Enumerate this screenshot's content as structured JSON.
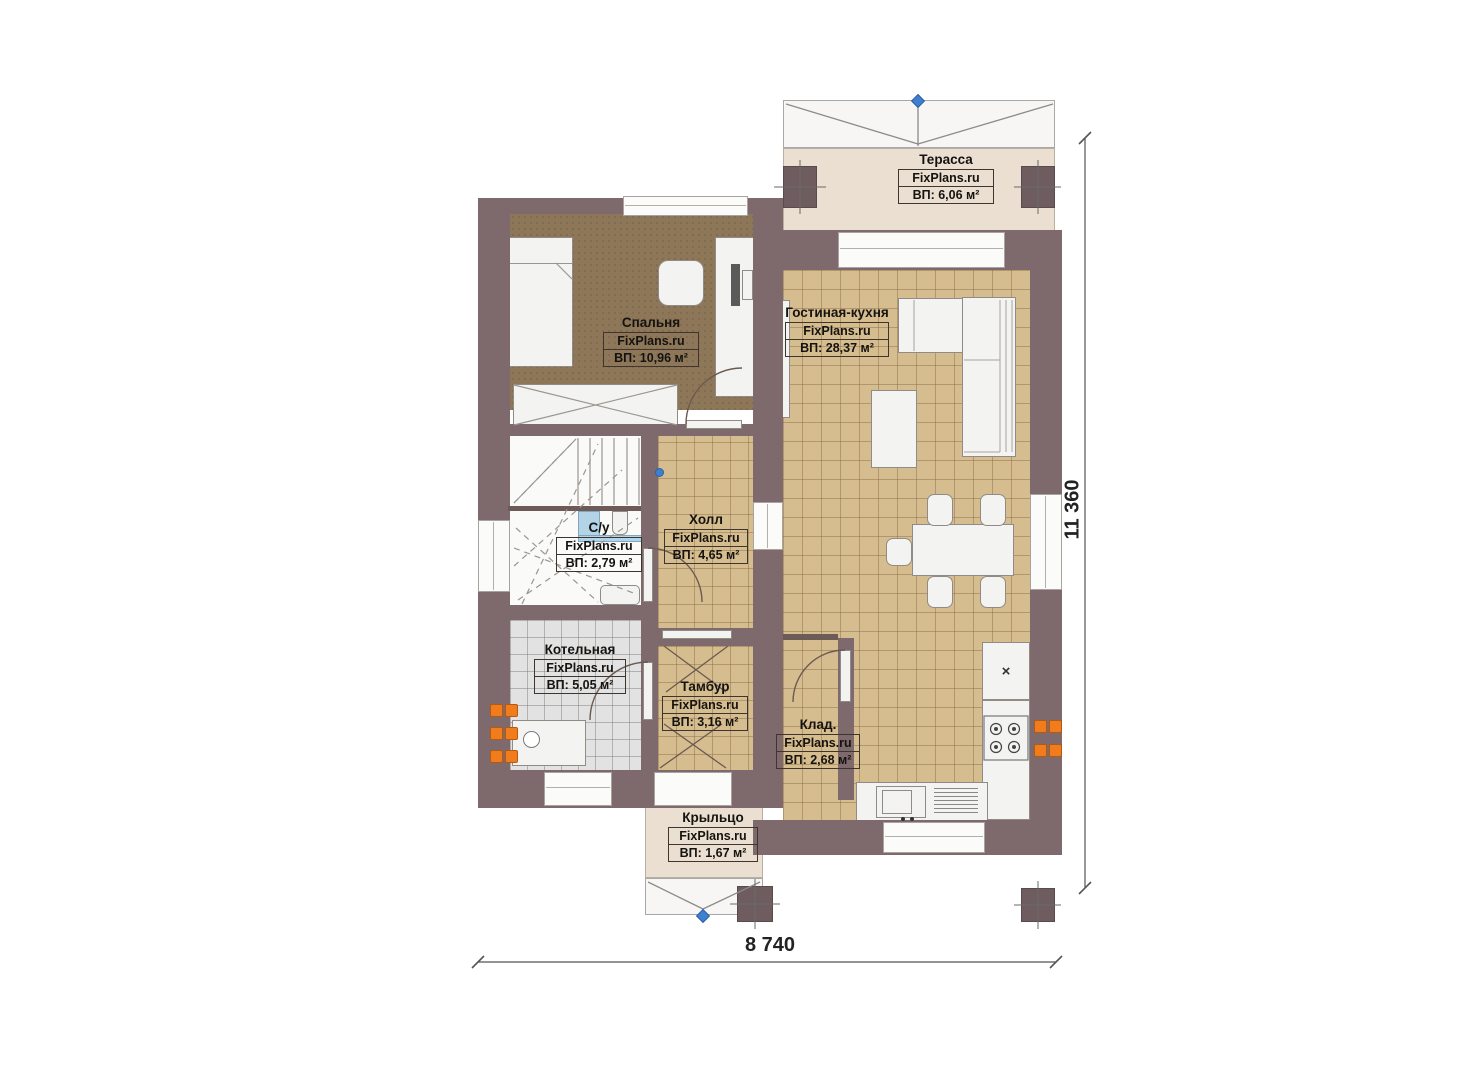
{
  "site_brand": "FixPlans.ru",
  "plan": {
    "type": "floor-plan",
    "dimensions": {
      "bottom": "8 740",
      "right": "11 360"
    },
    "rooms": [
      {
        "key": "terrace",
        "name": "Терасса",
        "brand": "FixPlans.ru",
        "area": "ВП: 6,06 м²"
      },
      {
        "key": "bedroom",
        "name": "Спальня",
        "brand": "FixPlans.ru",
        "area": "ВП: 10,96 м²"
      },
      {
        "key": "living-kitchen",
        "name": "Гостиная-кухня",
        "brand": "FixPlans.ru",
        "area": "ВП: 28,37 м²"
      },
      {
        "key": "bathroom",
        "name": "С/у",
        "brand": "FixPlans.ru",
        "area": "ВП: 2,79 м²"
      },
      {
        "key": "hall",
        "name": "Холл",
        "brand": "FixPlans.ru",
        "area": "ВП: 4,65 м²"
      },
      {
        "key": "boiler-room",
        "name": "Котельная",
        "brand": "FixPlans.ru",
        "area": "ВП: 5,05 м²"
      },
      {
        "key": "vestibule",
        "name": "Тамбур",
        "brand": "FixPlans.ru",
        "area": "ВП: 3,16 м²"
      },
      {
        "key": "storage",
        "name": "Клад.",
        "brand": "FixPlans.ru",
        "area": "ВП: 2,68 м²"
      },
      {
        "key": "porch",
        "name": "Крыльцо",
        "brand": "FixPlans.ru",
        "area": "ВП: 1,67 м²"
      }
    ],
    "colors": {
      "wall": "#7e6a6d",
      "floor_tile_tan": "#d6bd8f",
      "floor_bedroom_brown": "#8d7758",
      "floor_boiler_gray": "#e2e2e2",
      "terrace_beige": "#eadfd0",
      "radiator_orange": "#f07c1e",
      "marker_blue": "#3f7fd0"
    }
  }
}
